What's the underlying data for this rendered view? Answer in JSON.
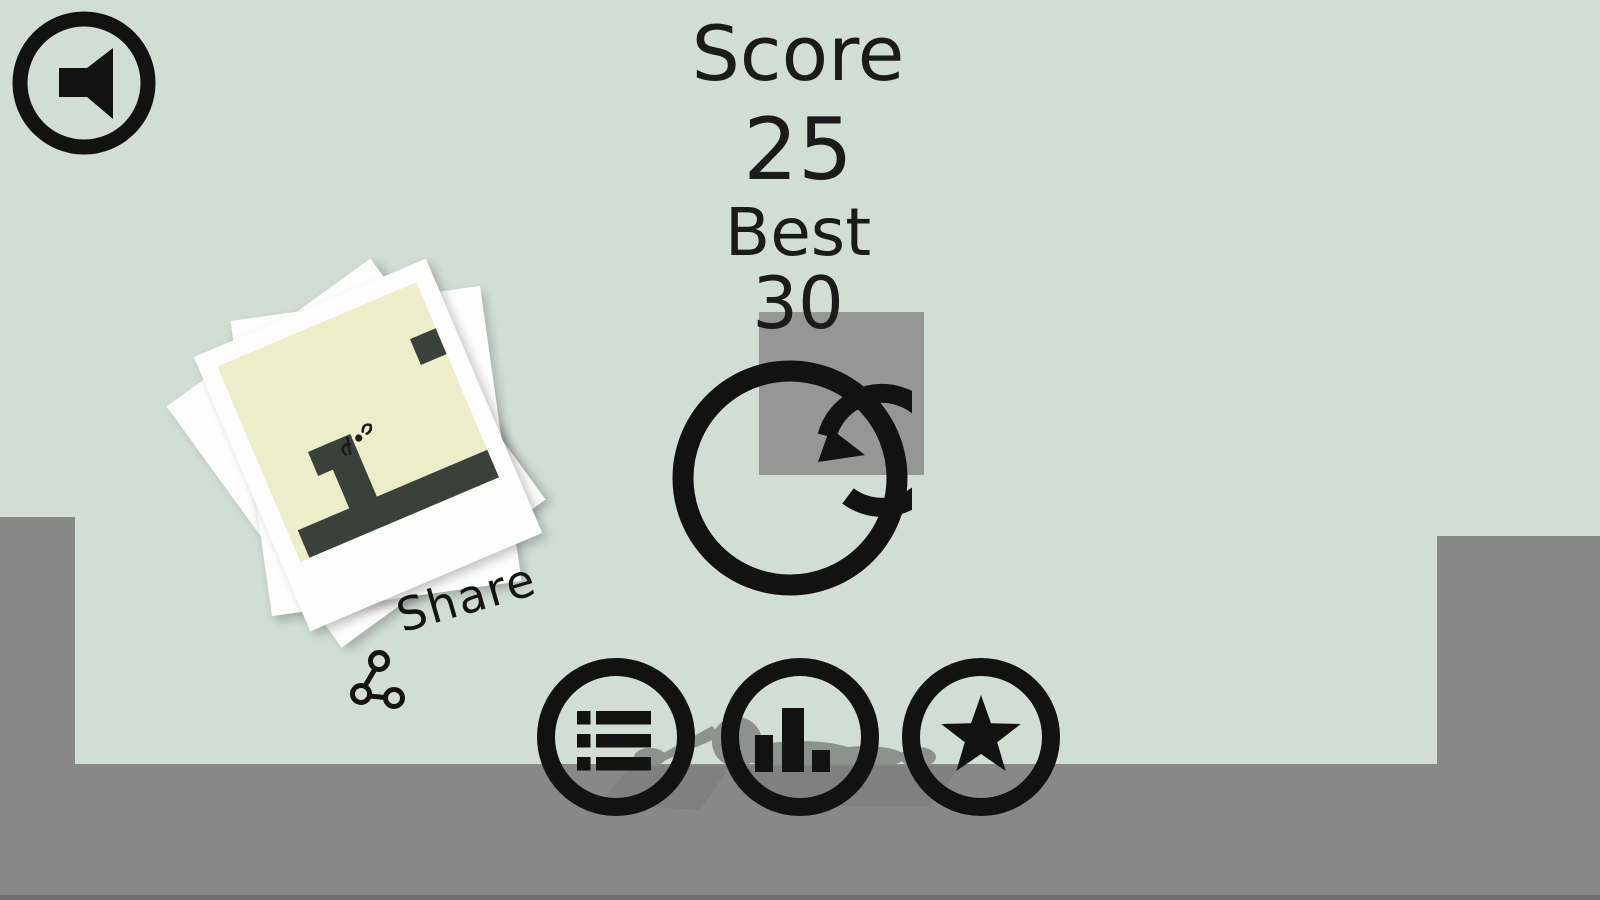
{
  "hud": {
    "score_label": "Score",
    "score_value": "25",
    "best_label": "Best",
    "best_value": "30"
  },
  "share": {
    "label": "Share"
  },
  "icons": {
    "sound": "speaker-icon",
    "restart": "circular-arrow-icon",
    "menu": "list-icon",
    "stats": "bar-chart-icon",
    "rate": "star-icon",
    "share": "share-nodes-icon"
  },
  "colors": {
    "background": "#d0ded6",
    "ground": "#888888",
    "obstacle_square": "#969696",
    "ink": "#121212",
    "photo_paper": "#fdfdfd",
    "photo_scene_bg": "#eceec9",
    "photo_scene_dark": "#39413b",
    "corpse_silhouette": "#8e928e"
  }
}
